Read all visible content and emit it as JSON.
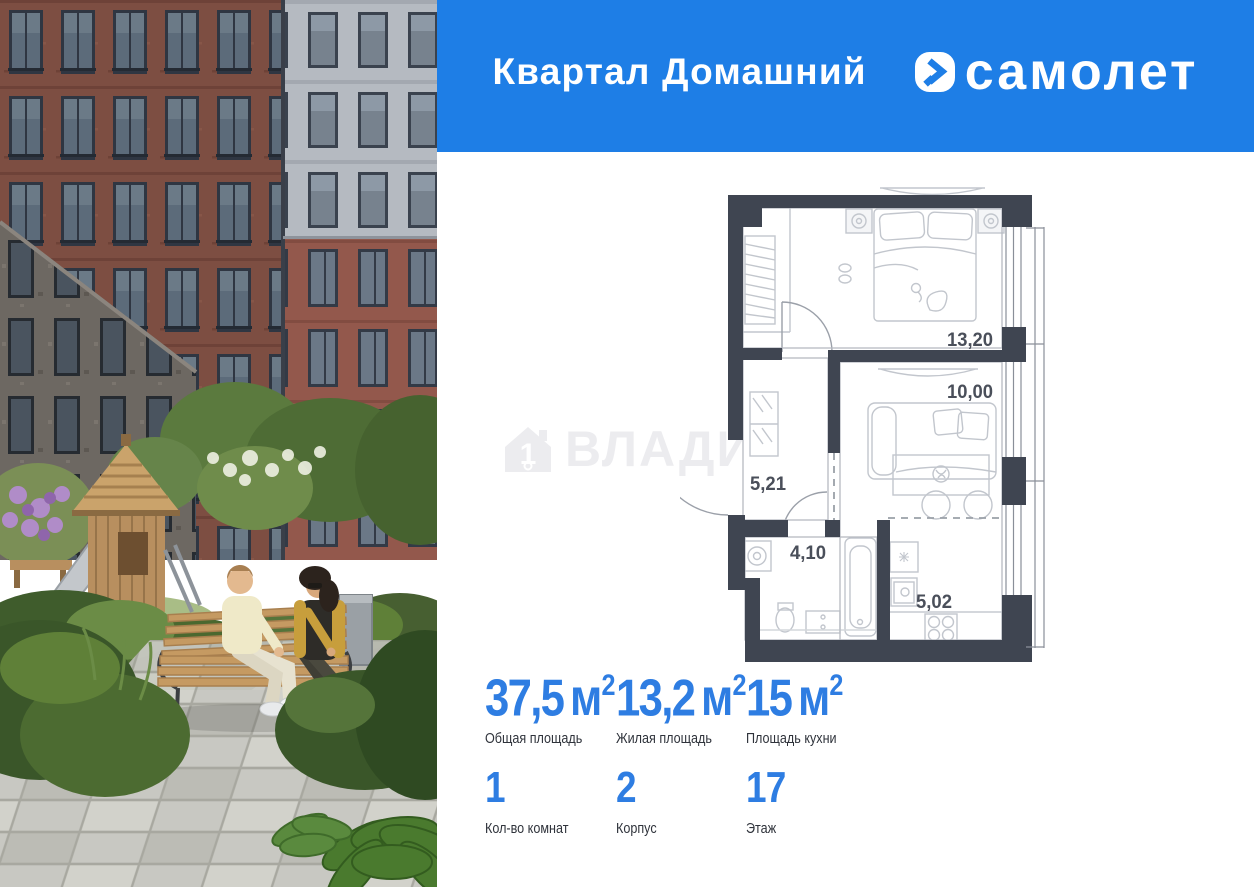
{
  "header": {
    "project_name": "Квартал Домашний",
    "brand_name": "самолет"
  },
  "watermark": {
    "text": "ВЛАДИС"
  },
  "floor_plan": {
    "dimensions": {
      "bedroom": "13,20",
      "living": "10,00",
      "hallway": "5,21",
      "bathroom": "4,10",
      "kitchen": "5,02"
    }
  },
  "stats": {
    "row1": [
      {
        "value": "37,5",
        "unit": "м",
        "sup": "2",
        "label": "Общая площадь"
      },
      {
        "value": "13,2",
        "unit": "м",
        "sup": "2",
        "label": "Жилая площадь"
      },
      {
        "value": "15",
        "unit": "м",
        "sup": "2",
        "label": "Площадь кухни"
      }
    ],
    "row2": [
      {
        "value": "1",
        "label": "Кол-во комнат"
      },
      {
        "value": "2",
        "label": "Корпус"
      },
      {
        "value": "17",
        "label": "Этаж"
      }
    ]
  },
  "icons": {
    "brand_icon": "samolet-arrow-icon",
    "watermark_icon": "house-number-icon"
  },
  "colors": {
    "header_blue": "#1e7ee6",
    "stat_blue": "#2e7de2",
    "plan_wall": "#3f4551"
  }
}
